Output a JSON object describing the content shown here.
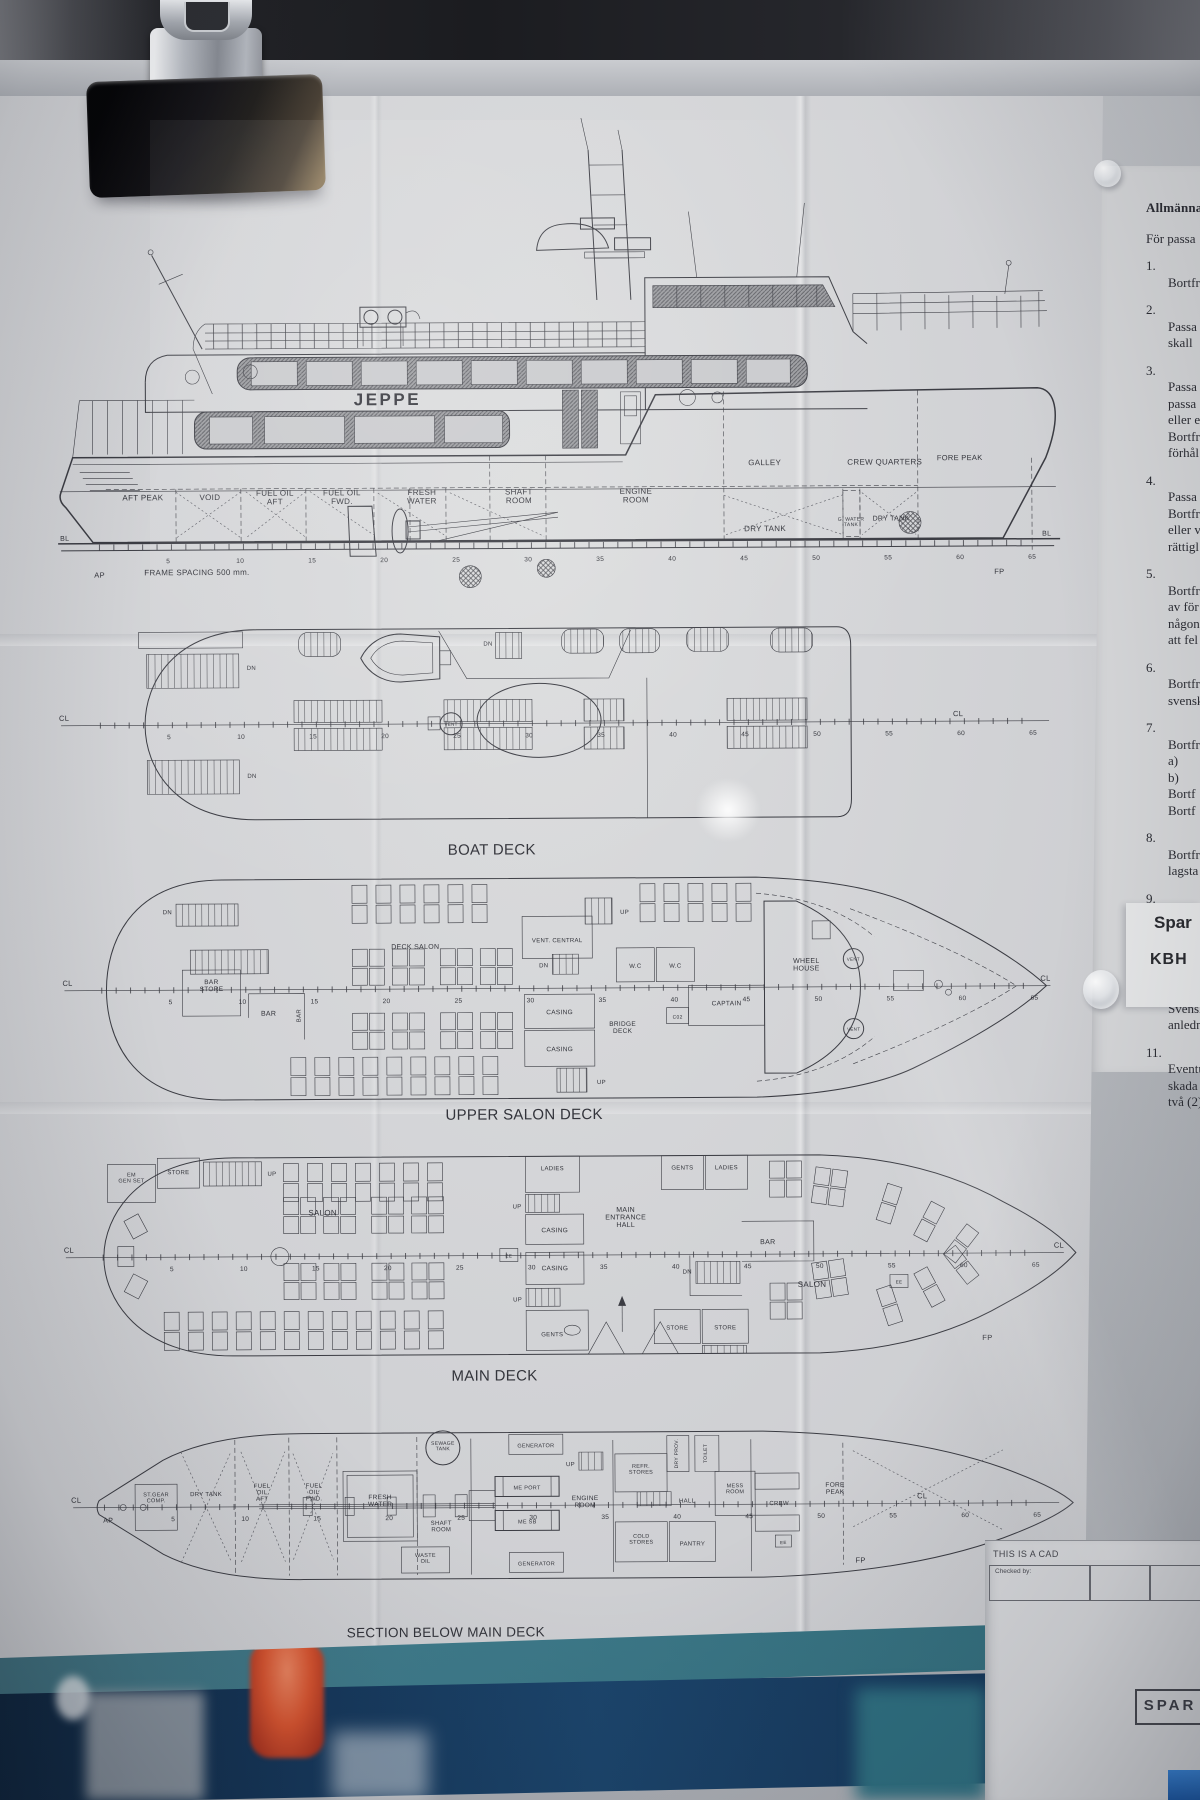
{
  "ship": {
    "name": "JEPPE"
  },
  "frame_ticks": [
    "5",
    "10",
    "15",
    "20",
    "25",
    "30",
    "35",
    "40",
    "45",
    "50",
    "55",
    "60",
    "65"
  ],
  "marks": {
    "ap": "AP",
    "fp": "FP",
    "bl": "BL",
    "cl": "CL",
    "up": "UP",
    "dn": "DN",
    "vent": "VENT",
    "ee": "EE",
    "co2": "C02",
    "frame_note": "FRAME SPACING 500 mm."
  },
  "profile": {
    "holds": [
      "AFT PEAK",
      "VOID",
      "FUEL OIL\nAFT",
      "FUEL OIL\nFWD.",
      "FRESH\nWATER",
      "SHAFT\nROOM",
      "ENGINE\nROOM"
    ],
    "upper": [
      "GALLEY",
      "CREW QUARTERS",
      "FORE PEAK"
    ],
    "tanks": [
      "DRY TANK",
      "G. WATER\nTANK",
      "DRY TANK"
    ]
  },
  "decks": {
    "boat": {
      "title": "BOAT DECK"
    },
    "upper": {
      "title": "UPPER SALON DECK",
      "deck_salon": "DECK SALON",
      "vent_central": "VENT. CENTRAL",
      "bar_store": "BAR\nSTORE",
      "bar": "BAR",
      "casing": "CASING",
      "bridge_deck": "BRIDGE\nDECK",
      "wc": "W.C",
      "wheel_house": "WHEEL\nHOUSE",
      "captain": "CAPTAIN"
    },
    "main": {
      "title": "MAIN DECK",
      "em_gen_set": "EM\nGEN SET",
      "store": "STORE",
      "salon": "SALON",
      "ladies": "LADIES",
      "gents": "GENTS",
      "casing": "CASING",
      "entrance_hall": "MAIN\nENTRANCE\nHALL",
      "bar": "BAR"
    },
    "below": {
      "title": "SECTION BELOW MAIN DECK",
      "st_gear": "ST.GEAR\nCOMP.",
      "dry_tank": "DRY TANK",
      "fuel_oil_aft": "FUEL\nOIL\nAFT",
      "fuel_oil_fwd": "FUEL\nOIL\nFWD.",
      "fresh_water": "FRESH\nWATER",
      "shaft_room": "SHAFT\nROOM",
      "sewage_tank": "SEWAGE\nTANK",
      "generator": "GENERATOR",
      "me_port": "ME PORT",
      "me_sb": "ME SB",
      "engine_room": "ENGINE\nROOM",
      "waste_oil": "WASTE\nOIL",
      "refr_stores": "REFR.\nSTORES",
      "dry_prov": "DRY PROV.",
      "toilet": "TOILET",
      "hall": "HALL",
      "mess_room": "MESS\nROOM",
      "cold_stores": "COLD\nSTORES",
      "pantry": "PANTRY",
      "crew": "CREW",
      "fore_peak": "FORE\nPEAK"
    }
  },
  "swedish_doc": {
    "header": "Allmänna",
    "intro": "För passa",
    "items": [
      {
        "n": "1.",
        "lines": [
          "Bortfr"
        ]
      },
      {
        "n": "2.",
        "lines": [
          "Passa",
          "skall"
        ]
      },
      {
        "n": "3.",
        "lines": [
          "Passa",
          "passa",
          "eller e",
          "Bortfr",
          "förhål"
        ]
      },
      {
        "n": "4.",
        "lines": [
          "Passa",
          "Bortfr",
          "eller v",
          "rättigl"
        ]
      },
      {
        "n": "5.",
        "lines": [
          "Bortfr",
          "av för",
          "någon",
          "att fel"
        ]
      },
      {
        "n": "6.",
        "lines": [
          "Bortfr",
          "svensk"
        ]
      },
      {
        "n": "7.",
        "lines": [
          "Bortfr",
          "a)",
          "b)",
          "Bortf",
          "Bortf"
        ]
      },
      {
        "n": "8.",
        "lines": [
          "Bortfr",
          "lagsta"
        ]
      },
      {
        "n": "9.",
        "lines": [
          "Bortfr",
          "angive",
          "omstän",
          "trafikf"
        ]
      },
      {
        "n": "10.",
        "lines": [
          "Svensk",
          "anledni"
        ]
      },
      {
        "n": "11.",
        "lines": [
          "Eventu",
          "skada e",
          "två (2)"
        ]
      }
    ],
    "note": {
      "line1": "Spar",
      "line2": "KBH"
    }
  },
  "title_block": {
    "cad_note": "THIS IS A CAD",
    "checked_by": "Checked by:",
    "stamp": "SPAR"
  },
  "colors": {
    "board_teal": "#3f7b8b",
    "board_blue": "#16375a",
    "paper": "#d2d3d6",
    "ink": "#3a3b42",
    "accent_orange": "#cc4a2b",
    "stamp_blue": "#2a6fc4"
  }
}
